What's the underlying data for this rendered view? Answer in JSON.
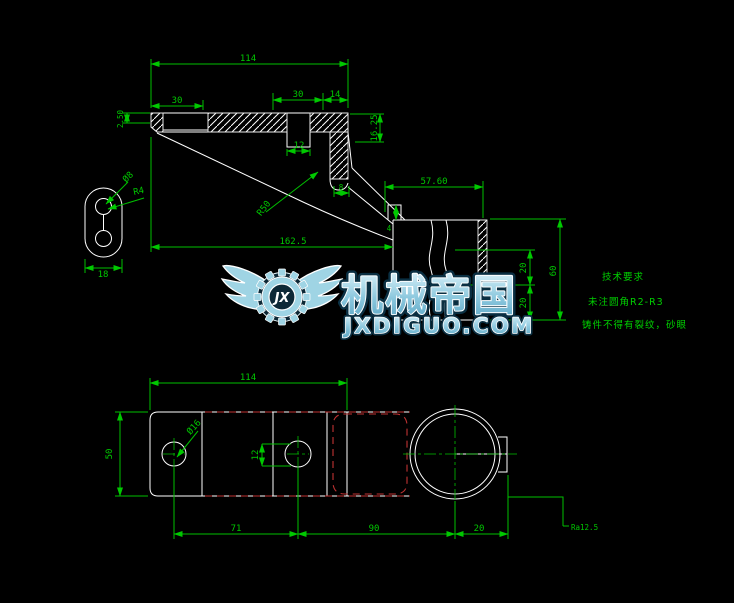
{
  "drawing_title": "CAD bracket drawing",
  "colors": {
    "background": "#000000",
    "outline": "#ffffff",
    "dimension_green": "#00c800",
    "hidden_red": "#c03232",
    "watermark_fill": "#9fd4e4",
    "watermark_outline": "#ffffff",
    "watermark_shadow": "#0a2f42"
  },
  "front_view": {
    "d114": "114",
    "d30a": "30",
    "d30b": "30",
    "d14": "14",
    "d12": "12",
    "d1625": "16.25",
    "d250": "2.50",
    "dphi8": "Ø8",
    "dr4": "R4",
    "d18": "18",
    "d162_5": "162.5",
    "dr50": "R50",
    "d8": "8",
    "d5760": "57.60",
    "d4": "4",
    "d20a": "20",
    "d20b": "20",
    "d60": "60"
  },
  "bottom_view": {
    "d114": "114",
    "d50": "50",
    "dphi16": "Ø16",
    "d12": "12",
    "d71": "71",
    "d90": "90",
    "d20": "20",
    "ra": "Ra12.5"
  },
  "notes": {
    "title": "技术要求",
    "rule1": "未注圆角R2-R3",
    "rule2": "铸件不得有裂纹，砂眼"
  },
  "watermark": {
    "brand": "机械帝国",
    "site": "JXDIGUO.COM",
    "monogram": "JX"
  }
}
